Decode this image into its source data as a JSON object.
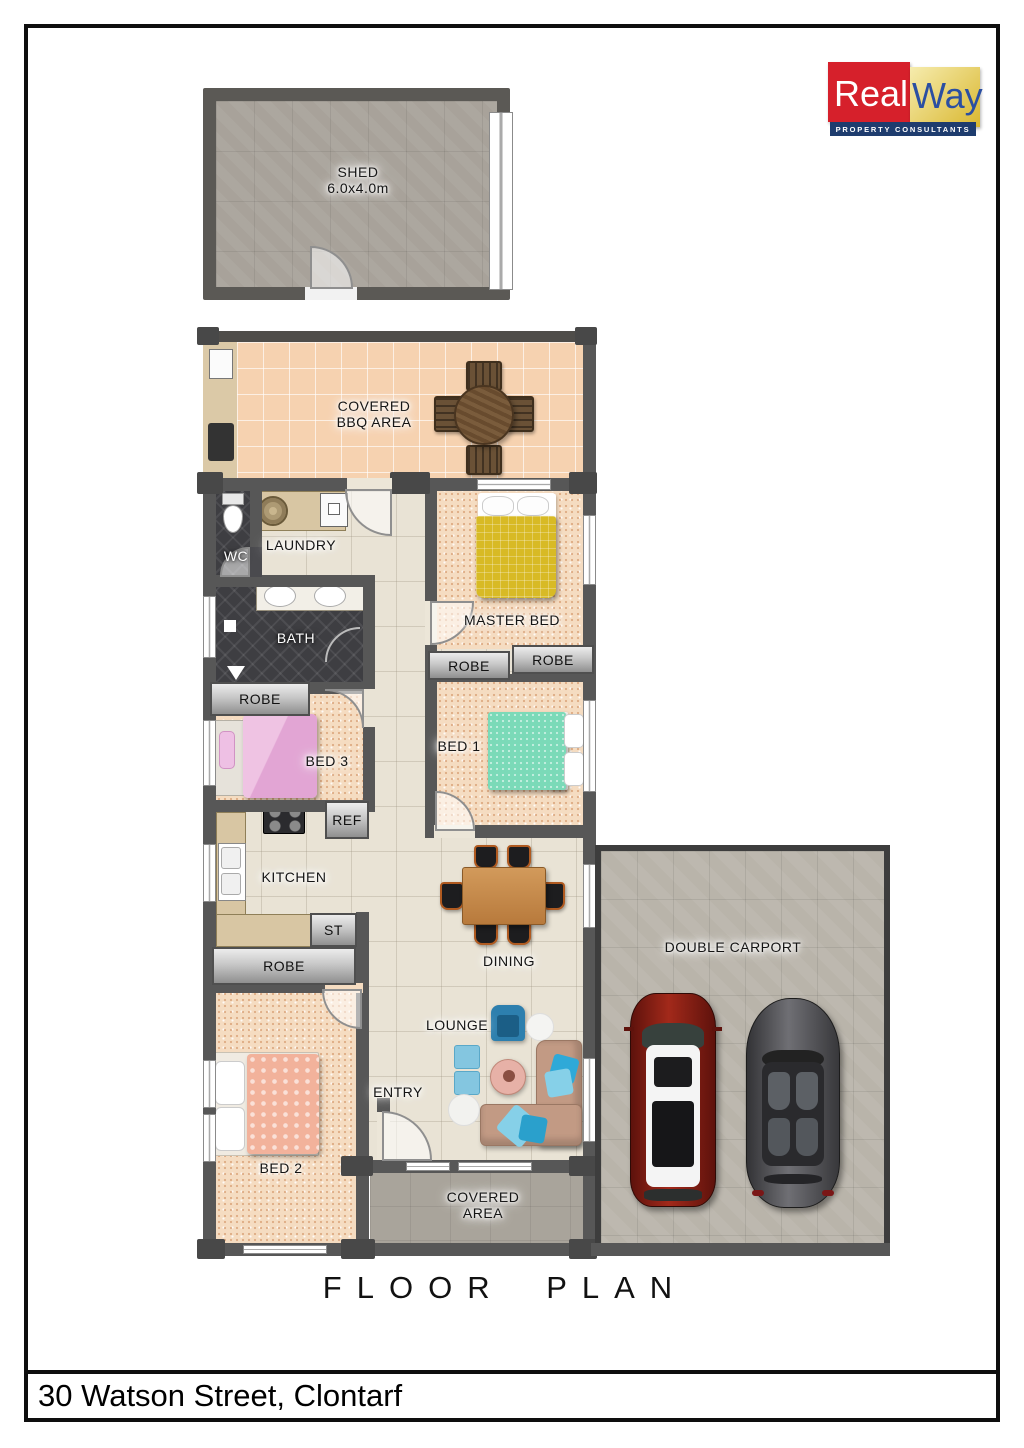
{
  "page": {
    "title": "FLOOR PLAN",
    "address": "30 Watson Street, Clontarf"
  },
  "logo": {
    "brand_real": "Real",
    "brand_way": "Way",
    "tagline": "PROPERTY CONSULTANTS",
    "red": "#d6202b",
    "gold": "#e3bf45",
    "navy": "#1e3c6e"
  },
  "rooms": {
    "shed": {
      "name": "SHED",
      "dims": "6.0x4.0m"
    },
    "bbq": {
      "line1": "COVERED",
      "line2": "BBQ AREA"
    },
    "wc": "WC",
    "laundry": "LAUNDRY",
    "bath": "BATH",
    "robe_bath": "ROBE",
    "robe_master_left": "ROBE",
    "robe_master_right": "ROBE",
    "robe_bed2": "ROBE",
    "master_bed": "MASTER BED",
    "bed1": "BED 1",
    "bed2": "BED 2",
    "bed3": "BED 3",
    "ref": "REF",
    "kitchen": "KITCHEN",
    "st": "ST",
    "dining": "DINING",
    "lounge": "LOUNGE",
    "entry": "ENTRY",
    "covered": {
      "line1": "COVERED",
      "line2": "AREA"
    },
    "carport": "DOUBLE CARPORT"
  },
  "colors": {
    "wall": "#575757",
    "carpet": "#f5dcc1",
    "tile_living": "#e9e3d5",
    "tile_bbq": "#f6d2b0",
    "concrete_shed": "#a8a29a",
    "concrete_carport": "#b9b4aa",
    "concrete_covered": "#a9a49b",
    "bed_master": "#d8ba25",
    "bed_1": "#7bdab8",
    "bed_2": "#f2b29b",
    "bed_3": "#e7b0da",
    "sofa": "#c29a84",
    "accent_blue": "#2fa9d8",
    "car_red": "#a2291a",
    "car_gray": "#55555a"
  }
}
